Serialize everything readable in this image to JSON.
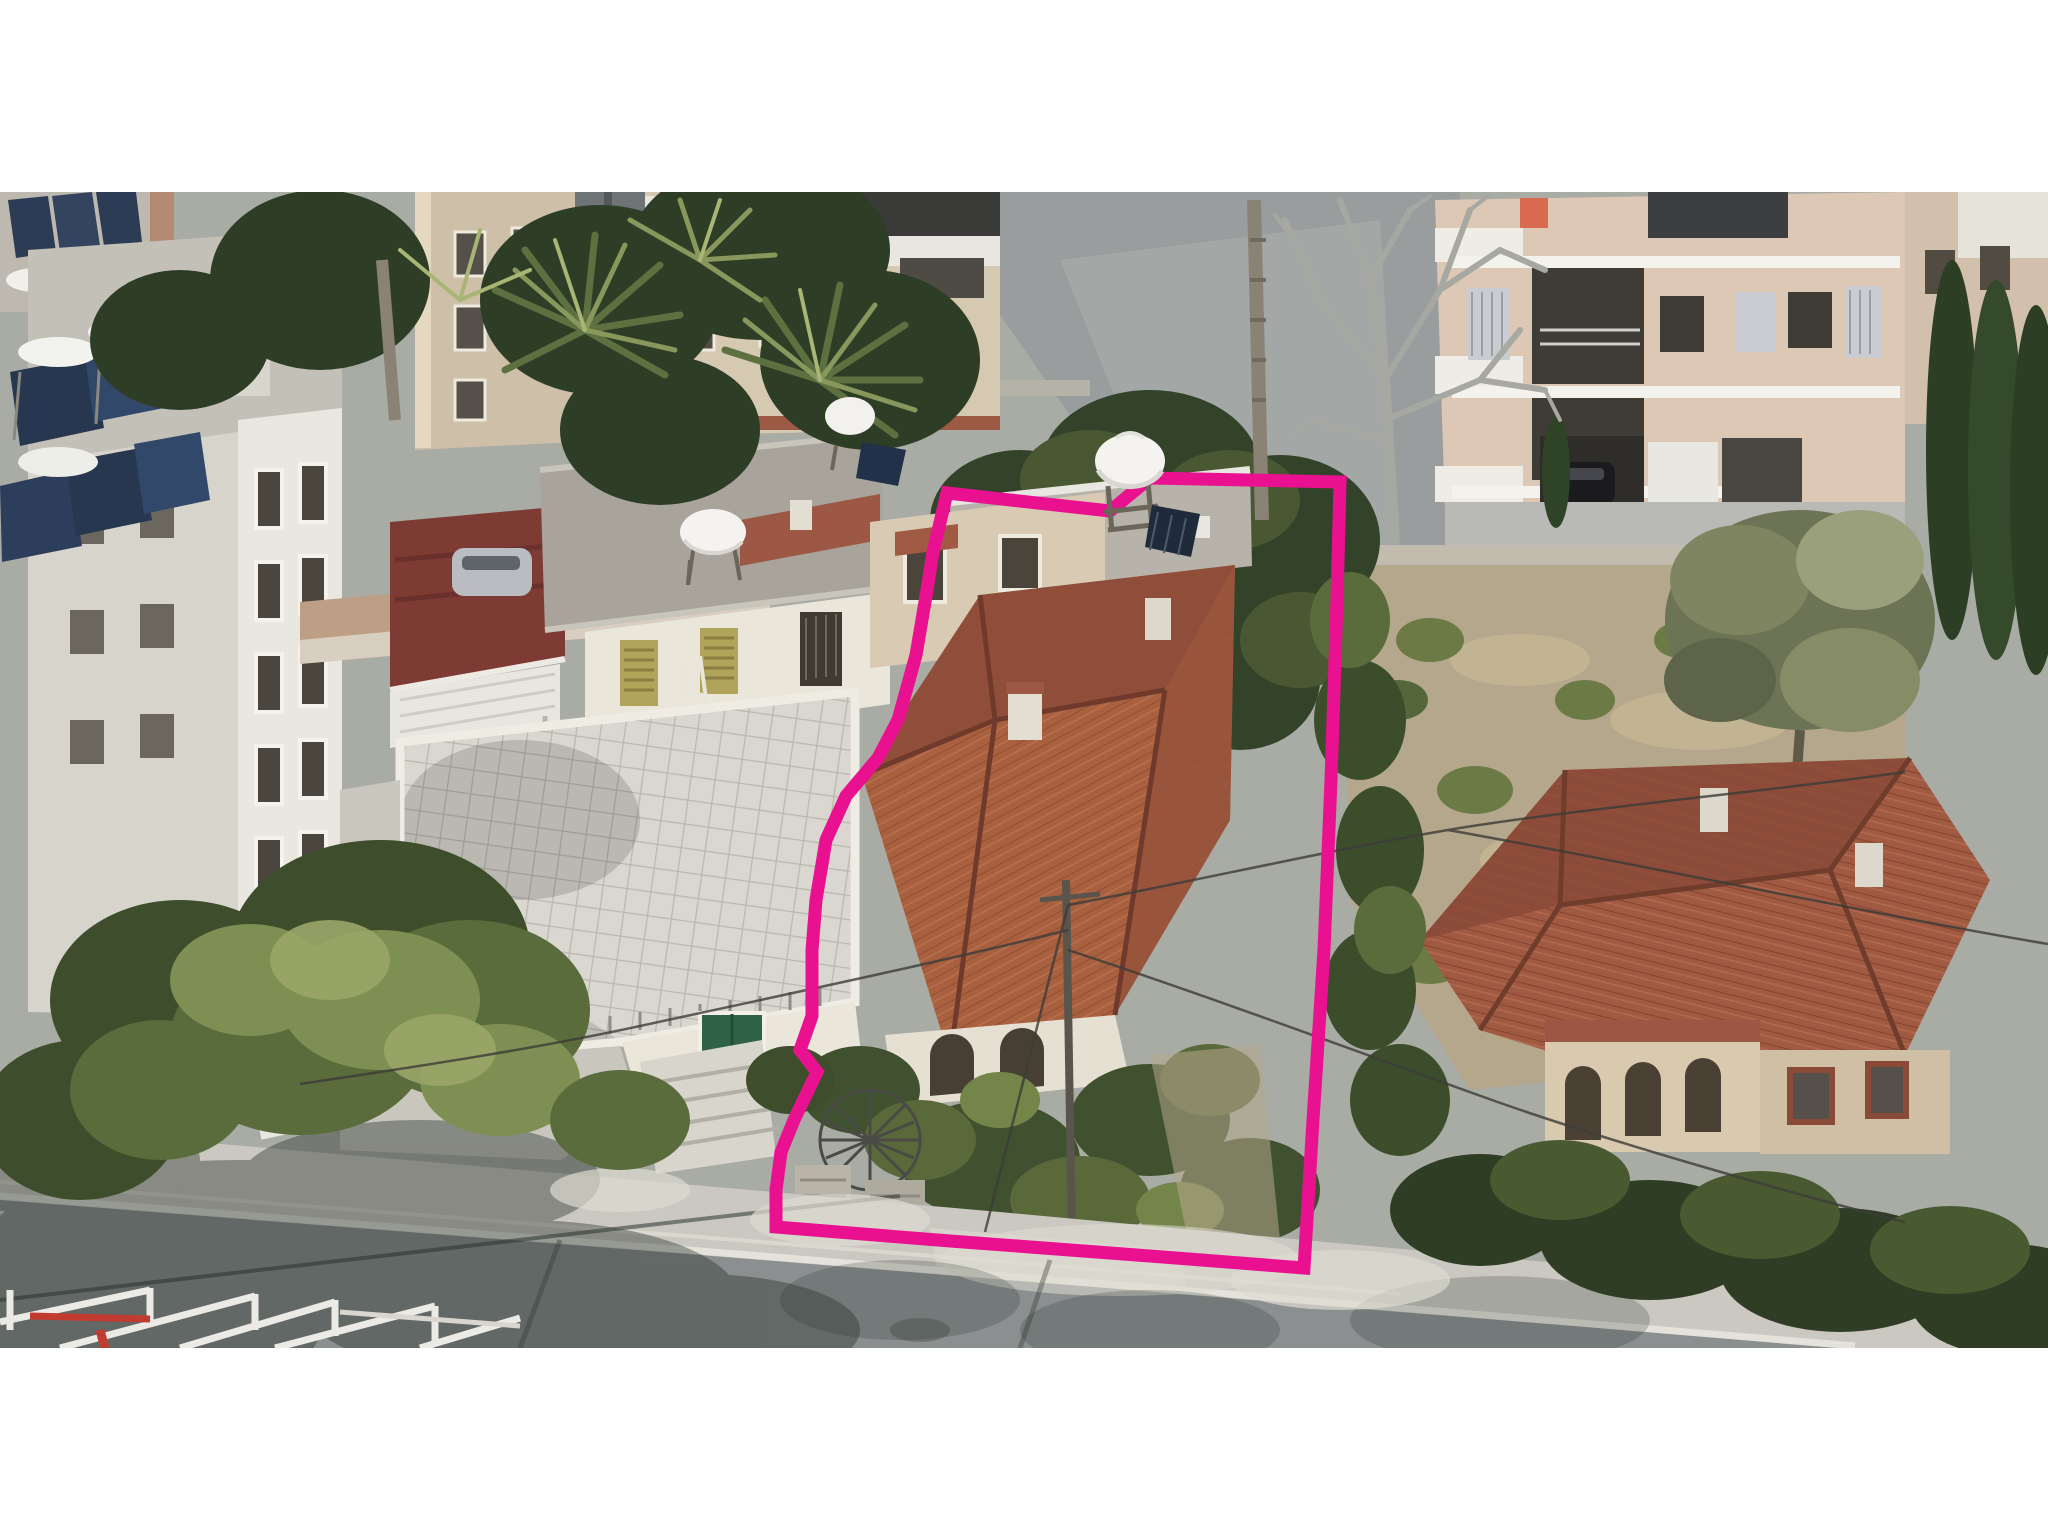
{
  "meta": {
    "type": "aerial-drone-photograph",
    "description": "Oblique aerial drone photo of a Mediterranean residential block; a detached house plot with a red hip-tiled roof is outlined with a hand-drawn magenta property boundary. White letterbox bars above and below the photo.",
    "location_style": "Cyprus urban neighbourhood, bright daylight"
  },
  "canvas": {
    "width": 2048,
    "height": 1536,
    "letterbox_color": "#ffffff",
    "photo_top": 192,
    "photo_height": 1156
  },
  "annotation": {
    "boundary_color": "#EA1190",
    "boundary_stroke_width": 13,
    "polygon_points": "947,493 1110,511 1150,478 1340,482 1337,600 1331,780 1324,950 1313,1120 1304,1268 1150,1256 950,1241 776,1227 776,1190 781,1152 794,1120 817,1072 800,1050 812,1016 812,950 816,900 826,840 846,796 878,758 898,720 916,655 927,590 933,552"
  },
  "scene": {
    "palette": {
      "asphalt": "#8b8f90",
      "sidewalk": "#cac8c0",
      "concrete_light": "#d8d6cf",
      "wall_cream": "#d9cbb3",
      "wall_pink_cream": "#dcc8b4",
      "wall_white": "#eae6da",
      "roof_red_lit": "#a9603f",
      "roof_red_dark": "#8d4c3a",
      "roof_red_right": "#a05a42",
      "roof_flat_gray": "#a8a49b",
      "maroon_terrace": "#7e3b34",
      "tree_dark": "#33432a",
      "tree_mid": "#55663a",
      "tree_light": "#7d8f52",
      "olive_tree": "#7f8560",
      "dead_tree": "#a8a8a2",
      "solar_panel": "#273750",
      "water_tank": "#f4f3ef"
    },
    "landmarks": [
      "left-white-apartment-tower-with-rooftop-solar-heaters",
      "top-row-apartment-buildings-with-balconies",
      "centre-palm-tree-cluster",
      "neighbour-house-white-tiled-terrace-roof-with-green-door-and-steps",
      "subject-property-red-hip-roof-house-inside-magenta-boundary",
      "rooftop-water-tanks-on-tripod-stands",
      "bare-winter-tree-over-back-lane",
      "right-vacant-lot-with-scrub-and-olive-tree",
      "right-derelict-red-roof-villa-with-arched-veranda",
      "bottom-street-with-sidewalk-kerb-tree-shadows-and-construction-barriers",
      "overhead-power-lines"
    ]
  }
}
